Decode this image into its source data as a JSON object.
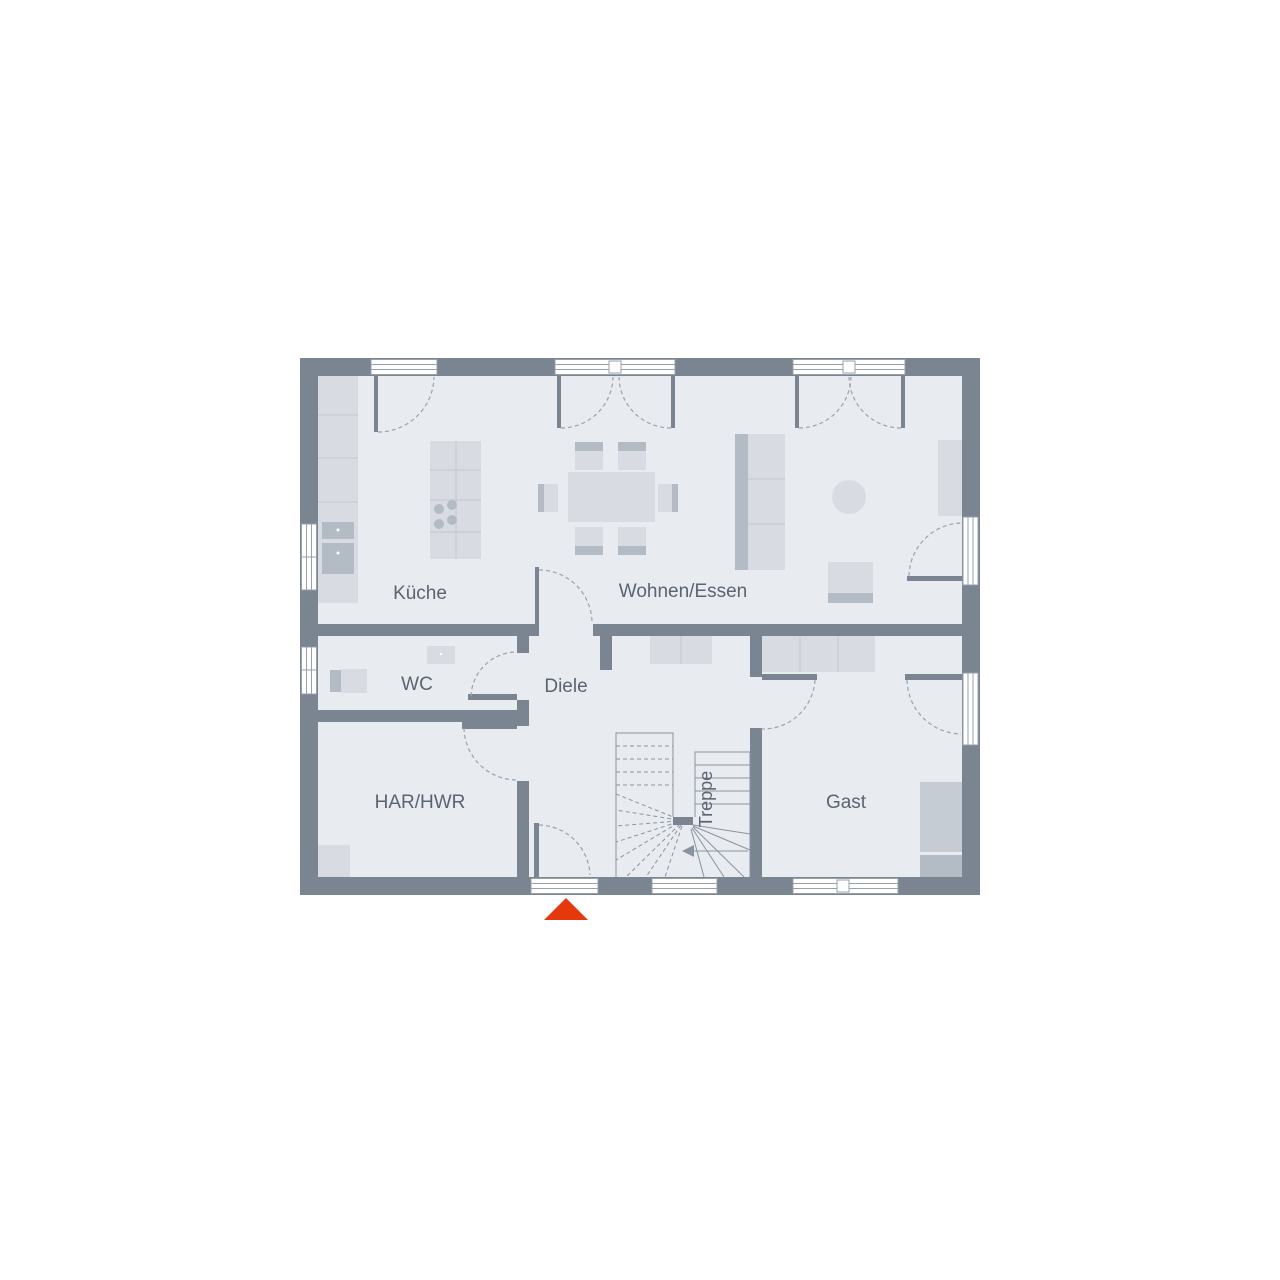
{
  "plan": {
    "type": "floor-plan",
    "rooms": [
      {
        "id": "kueche",
        "label": "Küche"
      },
      {
        "id": "wohnen-essen",
        "label": "Wohnen/Essen"
      },
      {
        "id": "wc",
        "label": "WC"
      },
      {
        "id": "diele",
        "label": "Diele"
      },
      {
        "id": "har-hwr",
        "label": "HAR/HWR"
      },
      {
        "id": "gast",
        "label": "Gast"
      },
      {
        "id": "treppe",
        "label": "Treppe"
      }
    ],
    "entrance_marker": {
      "symbol": "triangle",
      "meaning": "entrance"
    }
  },
  "colors": {
    "wall": "#7a8591",
    "floor": "#e8ebef",
    "furnlight": "#d8dce2",
    "furnmed": "#b3bbc5",
    "furnline": "#c2c8d0",
    "bedlight": "#c6ccd4",
    "dash": "#9ba3ad",
    "stair": "#8a94a0",
    "frame": "#97a0ab",
    "textcolor": "#5b6470",
    "accent": "#e6380d"
  }
}
